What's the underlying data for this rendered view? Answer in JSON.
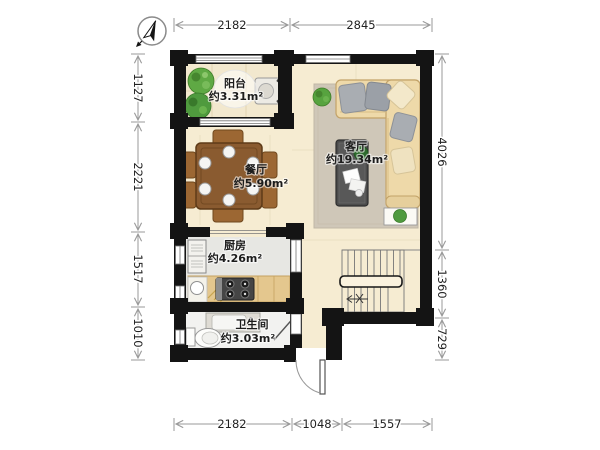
{
  "title": "apartment-floor-plan",
  "rooms": {
    "balcony": {
      "name": "阳台",
      "area": "约3.31m²"
    },
    "dining": {
      "name": "餐厅",
      "area": "约5.90m²"
    },
    "living": {
      "name": "客厅",
      "area": "约19.34m²"
    },
    "kitchen": {
      "name": "厨房",
      "area": "约4.26m²"
    },
    "bathroom": {
      "name": "卫生间",
      "area": "约3.03m²"
    }
  },
  "dimensions": {
    "top": [
      "2182",
      "2845"
    ],
    "bottom": [
      "2182",
      "1048",
      "1557"
    ],
    "left": [
      "1127",
      "2221",
      "1517",
      "1010"
    ],
    "right": [
      "4026",
      "1360",
      "729"
    ]
  },
  "icons": {
    "compass": "north-compass-icon"
  },
  "colors": {
    "wall": "#141414",
    "floor": "#f6ecd2",
    "balcony_tile": "#f2e8ce",
    "kitchen_floor": "#e7e7e3",
    "bath_floor": "#f2f2f0",
    "counter": "#e4c78e",
    "table_wood": "#8a5b30",
    "sofa": "#eed9a9",
    "rug": "#cfc7b8",
    "plant": "#4f9a3e",
    "dim_line": "#999999",
    "dim_text": "#222222"
  }
}
